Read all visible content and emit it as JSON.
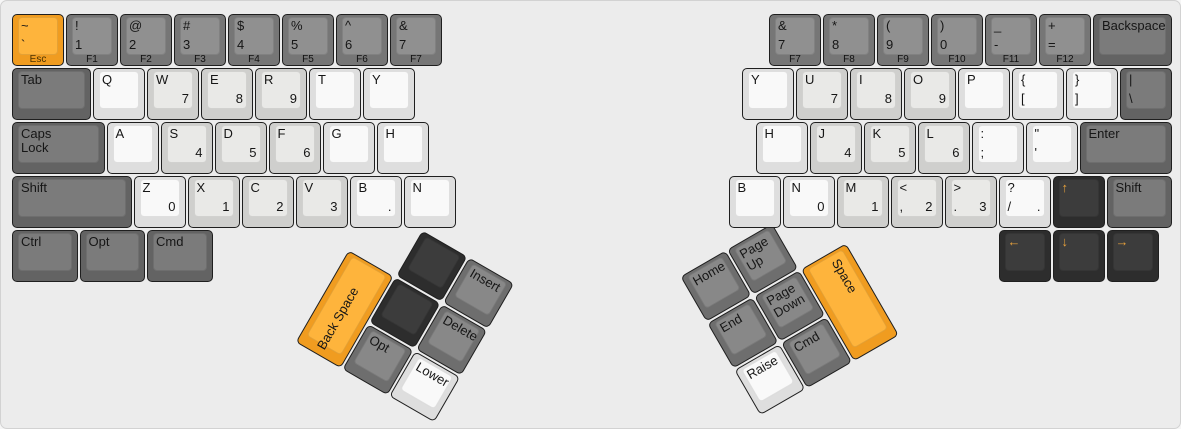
{
  "app": {
    "title": "keyboard-layout-editor split ergonomic keyboard"
  },
  "canvas": {
    "width": 1181,
    "height": 429,
    "unit": 54,
    "background": "#ececec"
  },
  "palette": {
    "orange_base": "#f09c20",
    "orange_top": "#feb43c",
    "frow_base": "#767676",
    "frow_top": "#909090",
    "modifier_base": "#636363",
    "modifier_top": "#7b7b7b",
    "thumb_base": "#6e6e6e",
    "thumb_top": "#888888",
    "dark_base": "#2d2d2d",
    "dark_top": "#3c3c3c",
    "white_base": "#dedede",
    "white_top": "#f9f9f9",
    "lightgray_base": "#cfcfcd",
    "lightgray_top": "#e9e9e7",
    "legend": "#161616",
    "arrow_legend": "#e9a23b"
  },
  "clusters": [
    {
      "id": "left-thumb-cluster",
      "x": 394,
      "y": 275,
      "angle": 30
    },
    {
      "id": "right-thumb-cluster",
      "x": 704.5,
      "y": 322,
      "angle": -30
    }
  ],
  "keys": [
    {
      "name": "esc",
      "x": 10,
      "y": 12,
      "color": "orange",
      "tl": "~",
      "bl": "`",
      "front": "Esc"
    },
    {
      "name": "f1",
      "x": 64,
      "y": 12,
      "color": "fgray",
      "tl": "!",
      "bl": "1",
      "front": "F1"
    },
    {
      "name": "f2",
      "x": 118,
      "y": 12,
      "color": "fgray",
      "tl": "@",
      "bl": "2",
      "front": "F2"
    },
    {
      "name": "f3",
      "x": 172,
      "y": 12,
      "color": "fgray",
      "tl": "#",
      "bl": "3",
      "front": "F3"
    },
    {
      "name": "f4",
      "x": 226,
      "y": 12,
      "color": "fgray",
      "tl": "$",
      "bl": "4",
      "front": "F4"
    },
    {
      "name": "f5",
      "x": 280,
      "y": 12,
      "color": "fgray",
      "tl": "%",
      "bl": "5",
      "front": "F5"
    },
    {
      "name": "f6",
      "x": 334,
      "y": 12,
      "color": "fgray",
      "tl": "^",
      "bl": "6",
      "front": "F6"
    },
    {
      "name": "f7-left",
      "x": 388,
      "y": 12,
      "color": "fgray",
      "tl": "&",
      "bl": "7",
      "front": "F7"
    },
    {
      "name": "tab",
      "x": 10,
      "y": 66,
      "w": 1.5,
      "color": "mgray",
      "tl": "Tab"
    },
    {
      "name": "q",
      "x": 91,
      "y": 66,
      "color": "white",
      "tl": "Q"
    },
    {
      "name": "w",
      "x": 145,
      "y": 66,
      "color": "lgray",
      "tl": "W",
      "br": "7"
    },
    {
      "name": "e",
      "x": 199,
      "y": 66,
      "color": "lgray",
      "tl": "E",
      "br": "8"
    },
    {
      "name": "r",
      "x": 253,
      "y": 66,
      "color": "lgray",
      "tl": "R",
      "br": "9"
    },
    {
      "name": "t",
      "x": 307,
      "y": 66,
      "color": "white",
      "tl": "T"
    },
    {
      "name": "y-left",
      "x": 361,
      "y": 66,
      "color": "white",
      "tl": "Y"
    },
    {
      "name": "caps-lock",
      "x": 10,
      "y": 120,
      "w": 1.75,
      "color": "mgray",
      "tl": "Caps\nLock"
    },
    {
      "name": "a",
      "x": 104.5,
      "y": 120,
      "color": "white",
      "tl": "A"
    },
    {
      "name": "s",
      "x": 158.5,
      "y": 120,
      "color": "lgray",
      "tl": "S",
      "br": "4"
    },
    {
      "name": "d",
      "x": 212.5,
      "y": 120,
      "color": "lgray",
      "tl": "D",
      "br": "5"
    },
    {
      "name": "f",
      "x": 266.5,
      "y": 120,
      "color": "lgray",
      "tl": "F",
      "br": "6"
    },
    {
      "name": "g",
      "x": 320.5,
      "y": 120,
      "color": "white",
      "tl": "G"
    },
    {
      "name": "h-left",
      "x": 374.5,
      "y": 120,
      "color": "white",
      "tl": "H"
    },
    {
      "name": "shift-left",
      "x": 10,
      "y": 174,
      "w": 2.25,
      "color": "mgray",
      "tl": "Shift"
    },
    {
      "name": "z",
      "x": 131.5,
      "y": 174,
      "color": "white",
      "tl": "Z",
      "br": "0"
    },
    {
      "name": "x",
      "x": 185.5,
      "y": 174,
      "color": "lgray",
      "tl": "X",
      "br": "1"
    },
    {
      "name": "c",
      "x": 239.5,
      "y": 174,
      "color": "lgray",
      "tl": "C",
      "br": "2"
    },
    {
      "name": "v",
      "x": 293.5,
      "y": 174,
      "color": "lgray",
      "tl": "V",
      "br": "3"
    },
    {
      "name": "b-left",
      "x": 347.5,
      "y": 174,
      "color": "white",
      "tl": "B",
      "br": "."
    },
    {
      "name": "n-left",
      "x": 401.5,
      "y": 174,
      "color": "white",
      "tl": "N"
    },
    {
      "name": "ctrl",
      "x": 10,
      "y": 228,
      "w": 1.25,
      "color": "mgray",
      "tl": "Ctrl"
    },
    {
      "name": "opt",
      "x": 77.5,
      "y": 228,
      "w": 1.25,
      "color": "mgray",
      "tl": "Opt"
    },
    {
      "name": "cmd",
      "x": 145,
      "y": 228,
      "w": 1.25,
      "color": "mgray",
      "tl": "Cmd"
    },
    {
      "name": "f7-right",
      "x": 767,
      "y": 12,
      "color": "fgray",
      "tl": "&",
      "bl": "7",
      "front": "F7"
    },
    {
      "name": "f8",
      "x": 821,
      "y": 12,
      "color": "fgray",
      "tl": "*",
      "bl": "8",
      "front": "F8"
    },
    {
      "name": "f9",
      "x": 875,
      "y": 12,
      "color": "fgray",
      "tl": "(",
      "bl": "9",
      "front": "F9"
    },
    {
      "name": "f10",
      "x": 929,
      "y": 12,
      "color": "fgray",
      "tl": ")",
      "bl": "0",
      "front": "F10"
    },
    {
      "name": "f11",
      "x": 983,
      "y": 12,
      "color": "fgray",
      "tl": "_",
      "bl": "-",
      "front": "F11"
    },
    {
      "name": "f12",
      "x": 1037,
      "y": 12,
      "color": "fgray",
      "tl": "+",
      "bl": "=",
      "front": "F12"
    },
    {
      "name": "backspace",
      "x": 1091,
      "y": 12,
      "w": 1.5,
      "color": "mgray",
      "tl": "Backspace"
    },
    {
      "name": "y-right",
      "x": 740,
      "y": 66,
      "color": "white",
      "tl": "Y"
    },
    {
      "name": "u",
      "x": 794,
      "y": 66,
      "color": "lgray",
      "tl": "U",
      "br": "7"
    },
    {
      "name": "i",
      "x": 848,
      "y": 66,
      "color": "lgray",
      "tl": "I",
      "br": "8"
    },
    {
      "name": "o",
      "x": 902,
      "y": 66,
      "color": "lgray",
      "tl": "O",
      "br": "9"
    },
    {
      "name": "p",
      "x": 956,
      "y": 66,
      "color": "white",
      "tl": "P"
    },
    {
      "name": "lbracket",
      "x": 1010,
      "y": 66,
      "color": "white",
      "tl": "{",
      "bl": "["
    },
    {
      "name": "rbracket",
      "x": 1064,
      "y": 66,
      "color": "white",
      "tl": "}",
      "bl": "]"
    },
    {
      "name": "backslash",
      "x": 1118,
      "y": 66,
      "color": "mgray",
      "tl": "|",
      "bl": "\\"
    },
    {
      "name": "h-right",
      "x": 753.5,
      "y": 120,
      "color": "white",
      "tl": "H"
    },
    {
      "name": "j",
      "x": 807.5,
      "y": 120,
      "color": "lgray",
      "tl": "J",
      "br": "4"
    },
    {
      "name": "k",
      "x": 861.5,
      "y": 120,
      "color": "lgray",
      "tl": "K",
      "br": "5"
    },
    {
      "name": "l",
      "x": 915.5,
      "y": 120,
      "color": "lgray",
      "tl": "L",
      "br": "6"
    },
    {
      "name": "semicolon",
      "x": 969.5,
      "y": 120,
      "color": "white",
      "tl": ":",
      "bl": ";"
    },
    {
      "name": "quote",
      "x": 1023.5,
      "y": 120,
      "color": "white",
      "tl": "\"",
      "bl": "'"
    },
    {
      "name": "enter",
      "x": 1077.5,
      "y": 120,
      "w": 1.75,
      "color": "mgray",
      "tl": "Enter"
    },
    {
      "name": "b-right",
      "x": 726.5,
      "y": 174,
      "color": "white",
      "tl": "B"
    },
    {
      "name": "n-right",
      "x": 780.5,
      "y": 174,
      "color": "white",
      "tl": "N",
      "br": "0"
    },
    {
      "name": "m",
      "x": 834.5,
      "y": 174,
      "color": "lgray",
      "tl": "M",
      "br": "1"
    },
    {
      "name": "comma",
      "x": 888.5,
      "y": 174,
      "color": "lgray",
      "tl": "<",
      "bl": ",",
      "br": "2"
    },
    {
      "name": "period",
      "x": 942.5,
      "y": 174,
      "color": "lgray",
      "tl": ">",
      "bl": ".",
      "br": "3"
    },
    {
      "name": "slash",
      "x": 996.5,
      "y": 174,
      "color": "white",
      "tl": "?",
      "bl": "/",
      "br": "."
    },
    {
      "name": "arrow-up",
      "x": 1050.5,
      "y": 174,
      "color": "dark",
      "tl": "↑",
      "lc": "orange"
    },
    {
      "name": "shift-right",
      "x": 1104.5,
      "y": 174,
      "w": 1.25,
      "color": "mgray",
      "tl": "Shift"
    },
    {
      "name": "arrow-left",
      "x": 996.5,
      "y": 228,
      "color": "dark",
      "tl": "←",
      "lc": "orange"
    },
    {
      "name": "arrow-down",
      "x": 1050.5,
      "y": 228,
      "color": "dark",
      "tl": "↓",
      "lc": "orange"
    },
    {
      "name": "arrow-right",
      "x": 1104.5,
      "y": 228,
      "color": "dark",
      "tl": "→",
      "lc": "orange"
    },
    {
      "name": "backspace-thumb",
      "cluster": "left-thumb-cluster",
      "x": -54,
      "y": 0,
      "h": 2,
      "color": "orange",
      "vtext": "Back Space",
      "vdir": "up"
    },
    {
      "name": "blank-1",
      "cluster": "left-thumb-cluster",
      "x": 0,
      "y": -54,
      "color": "dark"
    },
    {
      "name": "insert",
      "cluster": "left-thumb-cluster",
      "x": 54,
      "y": -54,
      "color": "tgray",
      "tl": "Insert"
    },
    {
      "name": "blank-2",
      "cluster": "left-thumb-cluster",
      "x": 0,
      "y": 0,
      "color": "dark"
    },
    {
      "name": "delete",
      "cluster": "left-thumb-cluster",
      "x": 54,
      "y": 0,
      "color": "tgray",
      "tl": "Delete"
    },
    {
      "name": "opt-thumb",
      "cluster": "left-thumb-cluster",
      "x": 0,
      "y": 54,
      "color": "tgray",
      "tl": "Opt"
    },
    {
      "name": "lower",
      "cluster": "left-thumb-cluster",
      "x": 54,
      "y": 54,
      "color": "white",
      "tl": "Lower"
    },
    {
      "name": "home",
      "cluster": "right-thumb-cluster",
      "x": 0,
      "y": -54,
      "color": "tgray",
      "tl": "Home"
    },
    {
      "name": "page-up",
      "cluster": "right-thumb-cluster",
      "x": 54,
      "y": -54,
      "color": "tgray",
      "tl": "Page\nUp"
    },
    {
      "name": "end",
      "cluster": "right-thumb-cluster",
      "x": 0,
      "y": 0,
      "color": "tgray",
      "tl": "End"
    },
    {
      "name": "page-down",
      "cluster": "right-thumb-cluster",
      "x": 54,
      "y": 0,
      "color": "tgray",
      "tl": "Page\nDown"
    },
    {
      "name": "raise",
      "cluster": "right-thumb-cluster",
      "x": 0,
      "y": 54,
      "color": "white",
      "tl": "Raise"
    },
    {
      "name": "cmd-thumb",
      "cluster": "right-thumb-cluster",
      "x": 54,
      "y": 54,
      "color": "tgray",
      "tl": "Cmd"
    },
    {
      "name": "space",
      "cluster": "right-thumb-cluster",
      "x": 108,
      "y": 0,
      "h": 2,
      "color": "orange",
      "vtext": "Space",
      "vdir": "down"
    }
  ]
}
